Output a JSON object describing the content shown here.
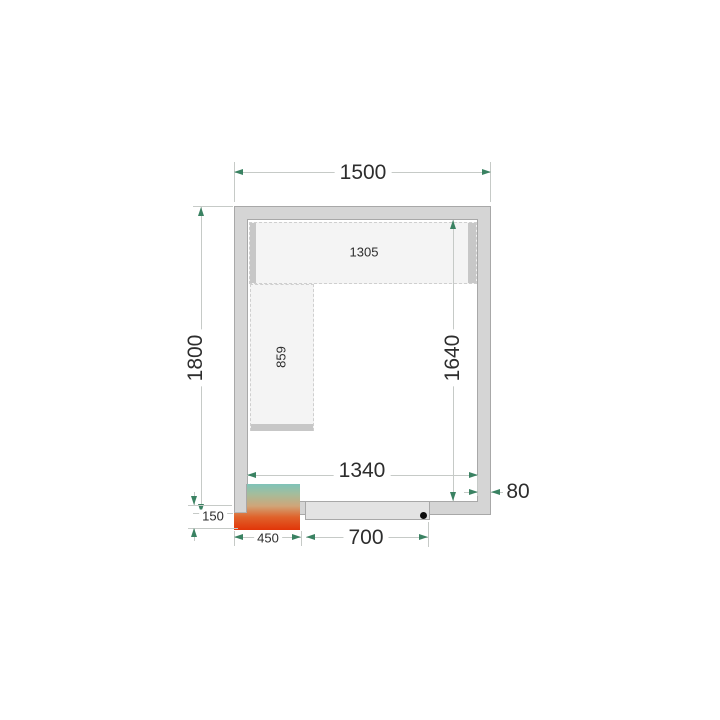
{
  "plan": {
    "dimensions": {
      "outer_width": "1500",
      "outer_depth": "1800",
      "inner_depth": "1640",
      "inner_width": "1340",
      "wall_thickness": "80",
      "unit_overhang": "150",
      "unit_width": "450",
      "door_width": "700"
    },
    "shelf_labels": {
      "top_shelf": "1305",
      "left_shelf": "859"
    },
    "colors": {
      "wall_fill": "#d5d5d5",
      "wall_stroke": "#a8a8a8",
      "door_fill": "#e3e3e3",
      "shelf_fill": "#f4f4f4",
      "dimension_line": "#c6cac7",
      "arrow": "#3a8262",
      "text": "#2d2d2d",
      "unit_gradient_top": "#7fc3b8",
      "unit_gradient_bottom": "#e13508"
    }
  }
}
